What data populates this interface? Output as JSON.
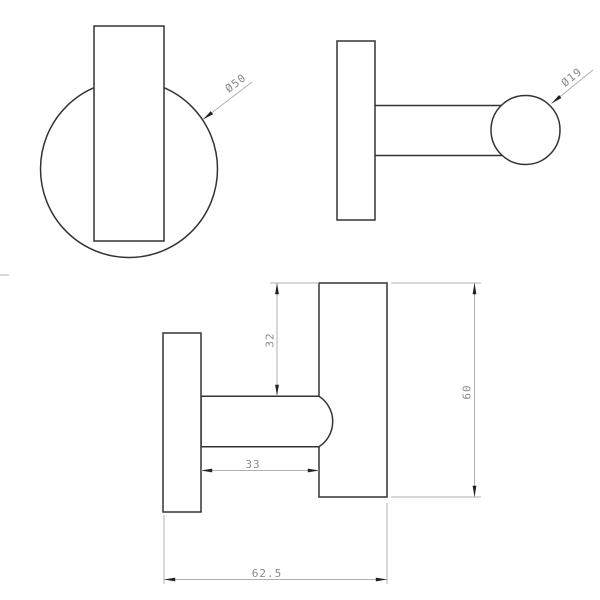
{
  "annotations": {
    "front_plate_diameter": "Ø50",
    "ball_diameter": "Ø19",
    "ball_center_offset": "32",
    "arm_length": "33",
    "bar_height": "60",
    "total_depth": "62.5"
  },
  "colors": {
    "background": "#ffffff",
    "object_line": "#333333",
    "dimension_line": "#b0b0b0",
    "dimension_text": "#8a8a8a",
    "arrow": "#222222"
  }
}
